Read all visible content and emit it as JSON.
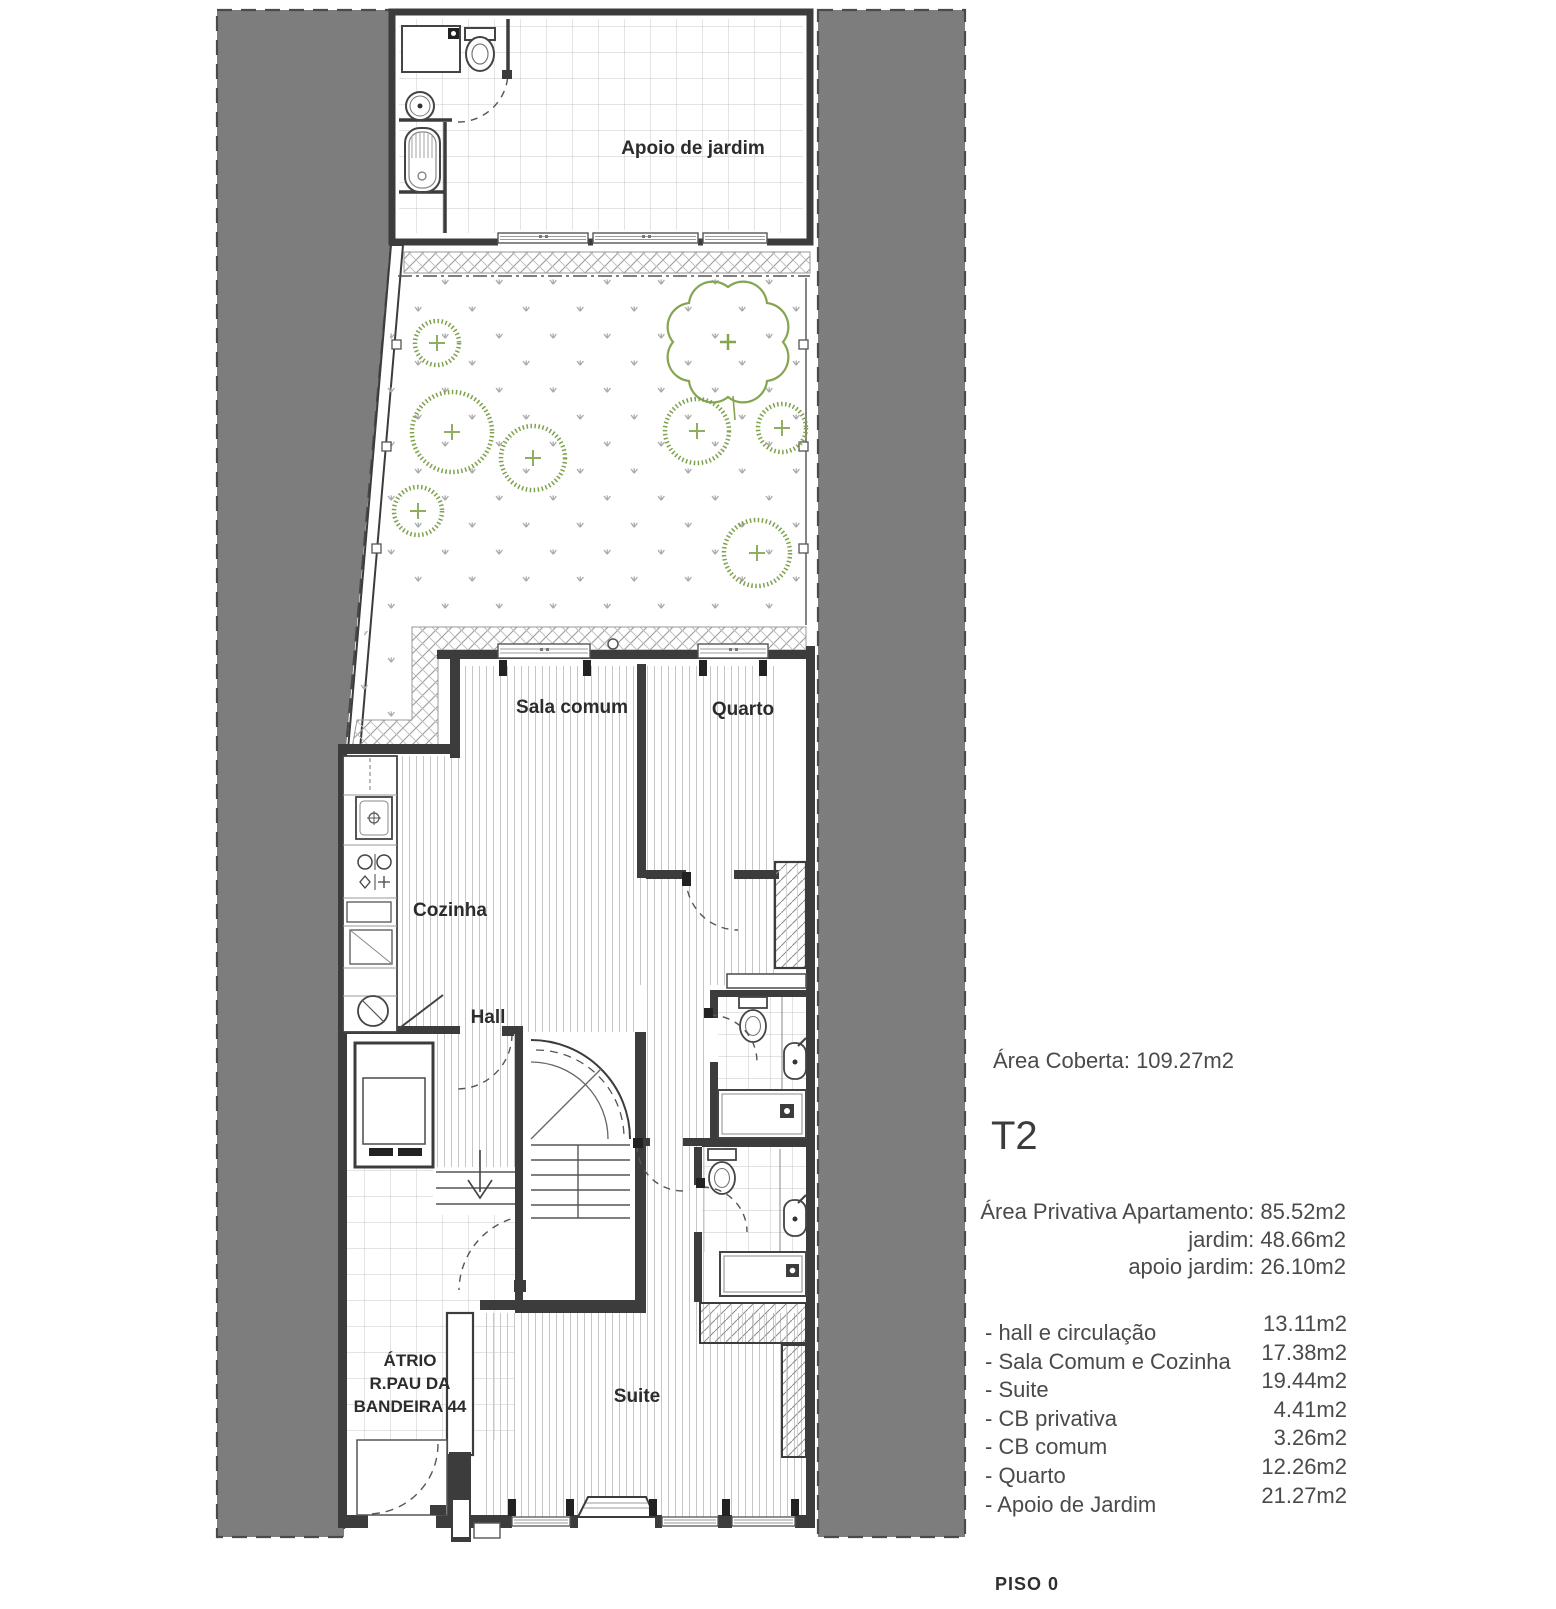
{
  "plan": {
    "rooms": {
      "apoio_jardim": "Apoio de jardim",
      "sala_comum": "Sala comum",
      "quarto": "Quarto",
      "cozinha": "Cozinha",
      "hall": "Hall",
      "suite": "Suite"
    },
    "atrio": {
      "line1": "ÁTRIO",
      "line2": "R.PAU DA",
      "line3": "BANDEIRA 44"
    }
  },
  "info": {
    "area_coberta": "Área Coberta: 109.27m2",
    "typology": "T2",
    "private_lines": [
      "Área Privativa Apartamento: 85.52m2",
      "jardim: 48.66m2",
      "apoio jardim: 26.10m2"
    ],
    "rooms": [
      {
        "label": "- hall e circulação",
        "area": "13.11m2"
      },
      {
        "label": "- Sala Comum e Cozinha",
        "area": "17.38m2"
      },
      {
        "label": "- Suite",
        "area": "19.44m2"
      },
      {
        "label": "- CB privativa",
        "area": "4.41m2"
      },
      {
        "label": "- CB comum",
        "area": "3.26m2"
      },
      {
        "label": "- Quarto",
        "area": "12.26m2"
      },
      {
        "label": "- Apoio de Jardim",
        "area": "21.27m2"
      }
    ],
    "floor_label": "PISO 0"
  },
  "colors": {
    "neighbor_gray": "#7d7d7d",
    "line_dark": "#3c3c3c",
    "vegetation_green": "#7da24c",
    "text_gray": "#4a4a4a"
  }
}
